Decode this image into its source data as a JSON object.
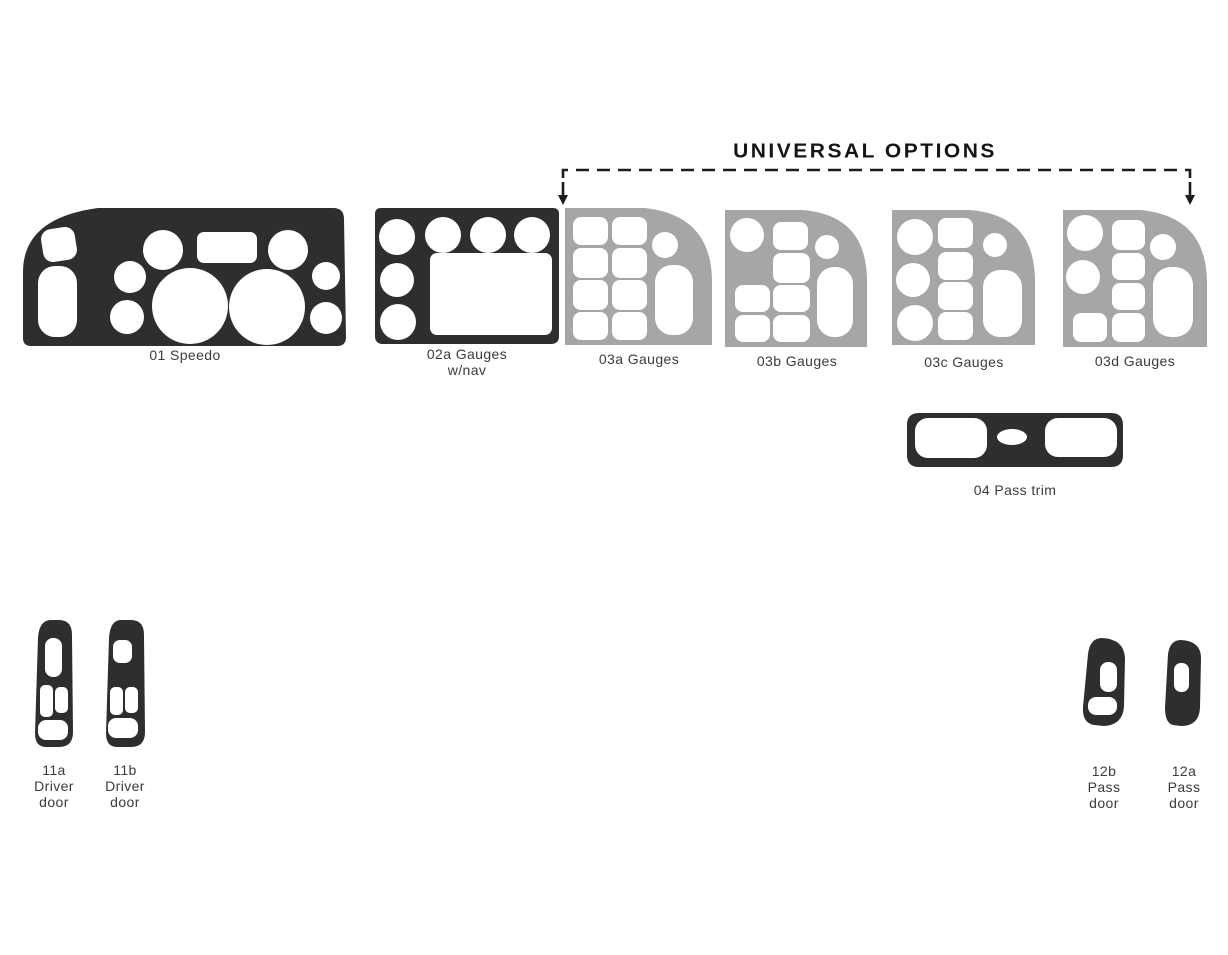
{
  "title": "UNIVERSAL OPTIONS",
  "colors": {
    "dark_piece": "#2e2e2e",
    "gray_piece": "#a6a6a6",
    "cutout": "#ffffff",
    "label_text": "#3b3b3b",
    "title_text": "#151515",
    "bracket_line": "#1c1c1c",
    "background": "#ffffff"
  },
  "pieces": {
    "speedo": {
      "label": "01 Speedo"
    },
    "gauges_02a": {
      "line1": "02a Gauges",
      "line2": "w/nav"
    },
    "gauges_03a": {
      "label": "03a Gauges"
    },
    "gauges_03b": {
      "label": "03b Gauges"
    },
    "gauges_03c": {
      "label": "03c Gauges"
    },
    "gauges_03d": {
      "label": "03d Gauges"
    },
    "pass_trim_04": {
      "label": "04 Pass trim"
    },
    "driver_door_11a": {
      "line1": "11a",
      "line2": "Driver",
      "line3": "door"
    },
    "driver_door_11b": {
      "line1": "11b",
      "line2": "Driver",
      "line3": "door"
    },
    "pass_door_12b": {
      "line1": "12b",
      "line2": "Pass",
      "line3": "door"
    },
    "pass_door_12a": {
      "line1": "12a",
      "line2": "Pass",
      "line3": "door"
    }
  }
}
